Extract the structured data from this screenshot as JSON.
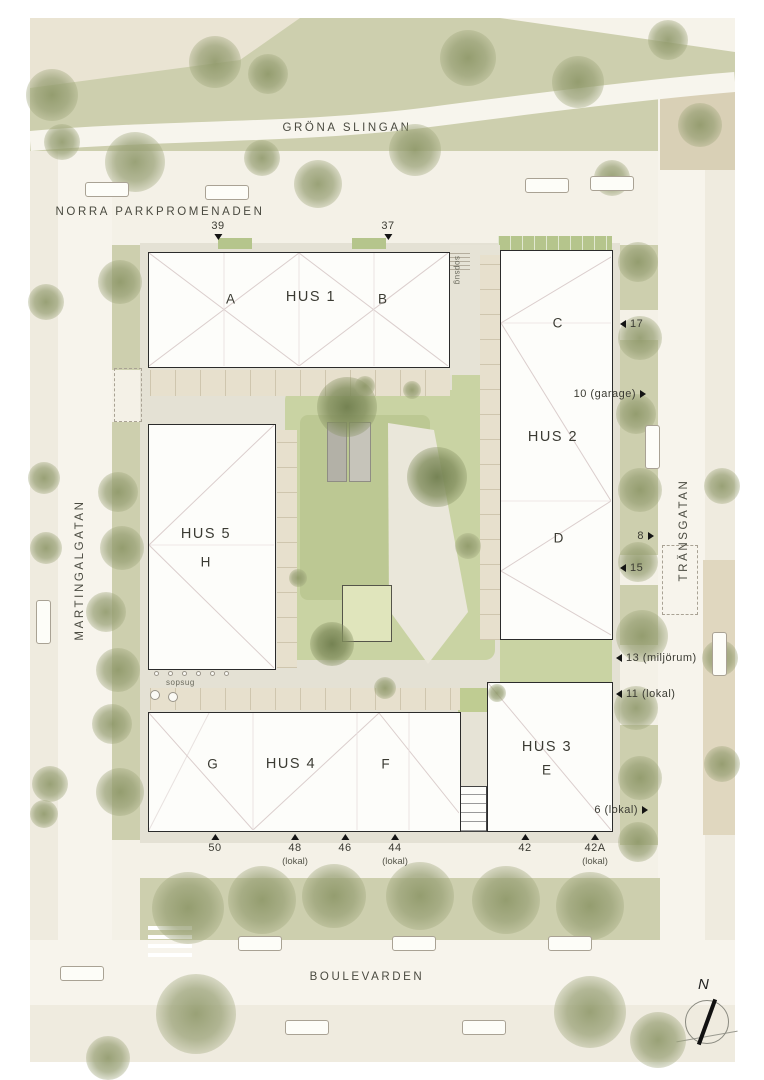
{
  "streets": {
    "park_path": "GRÖNA SLINGAN",
    "north": "NORRA PARKPROMENADEN",
    "west": "MARTINGALGATAN",
    "east": "TRÄNSGATAN",
    "south": "BOULEVARDEN"
  },
  "buildings": {
    "hus1": {
      "name": "HUS 1",
      "unit_left": "A",
      "unit_right": "B"
    },
    "hus2": {
      "name": "HUS 2",
      "unit_top": "C",
      "unit_bottom": "D"
    },
    "hus3": {
      "name": "HUS 3",
      "unit": "E"
    },
    "hus4": {
      "name": "HUS 4",
      "unit_left": "G",
      "unit_right": "F"
    },
    "hus5": {
      "name": "HUS 5",
      "unit": "H"
    }
  },
  "entrances": {
    "top": [
      {
        "label": "39"
      },
      {
        "label": "37"
      }
    ],
    "west": [
      {
        "label": "10 (garage)"
      },
      {
        "label": "8"
      },
      {
        "label": "6 (lokal)"
      }
    ],
    "east": [
      {
        "label": "17"
      },
      {
        "label": "15"
      },
      {
        "label": "13 (miljörum)"
      },
      {
        "label": "11 (lokal)"
      }
    ],
    "south": [
      {
        "label": "50",
        "sub": ""
      },
      {
        "label": "48",
        "sub": "(lokal)"
      },
      {
        "label": "46",
        "sub": ""
      },
      {
        "label": "44",
        "sub": "(lokal)"
      },
      {
        "label": "42",
        "sub": ""
      },
      {
        "label": "42A",
        "sub": "(lokal)"
      }
    ]
  },
  "annotations": {
    "sopsug_courtyard": "sopsug",
    "sopsug_passage": "sopsug"
  },
  "compass": {
    "north_label": "N"
  },
  "colors": {
    "cream": "#f4f1e7",
    "road": "#f7f4ec",
    "sidewalk": "#efebdf",
    "park_green": "#cdcfae",
    "courtyard_green": "#c9d3a3",
    "lawn_green": "#bcc893",
    "plot_green": "#b5c58c",
    "paving": "#e4e1d4",
    "tan_block": "#d9d0b6",
    "building_fill": "#fdfdfa",
    "building_border": "#2b2b2b",
    "roof_line": "#dbcecd",
    "text": "#3b3b33"
  }
}
